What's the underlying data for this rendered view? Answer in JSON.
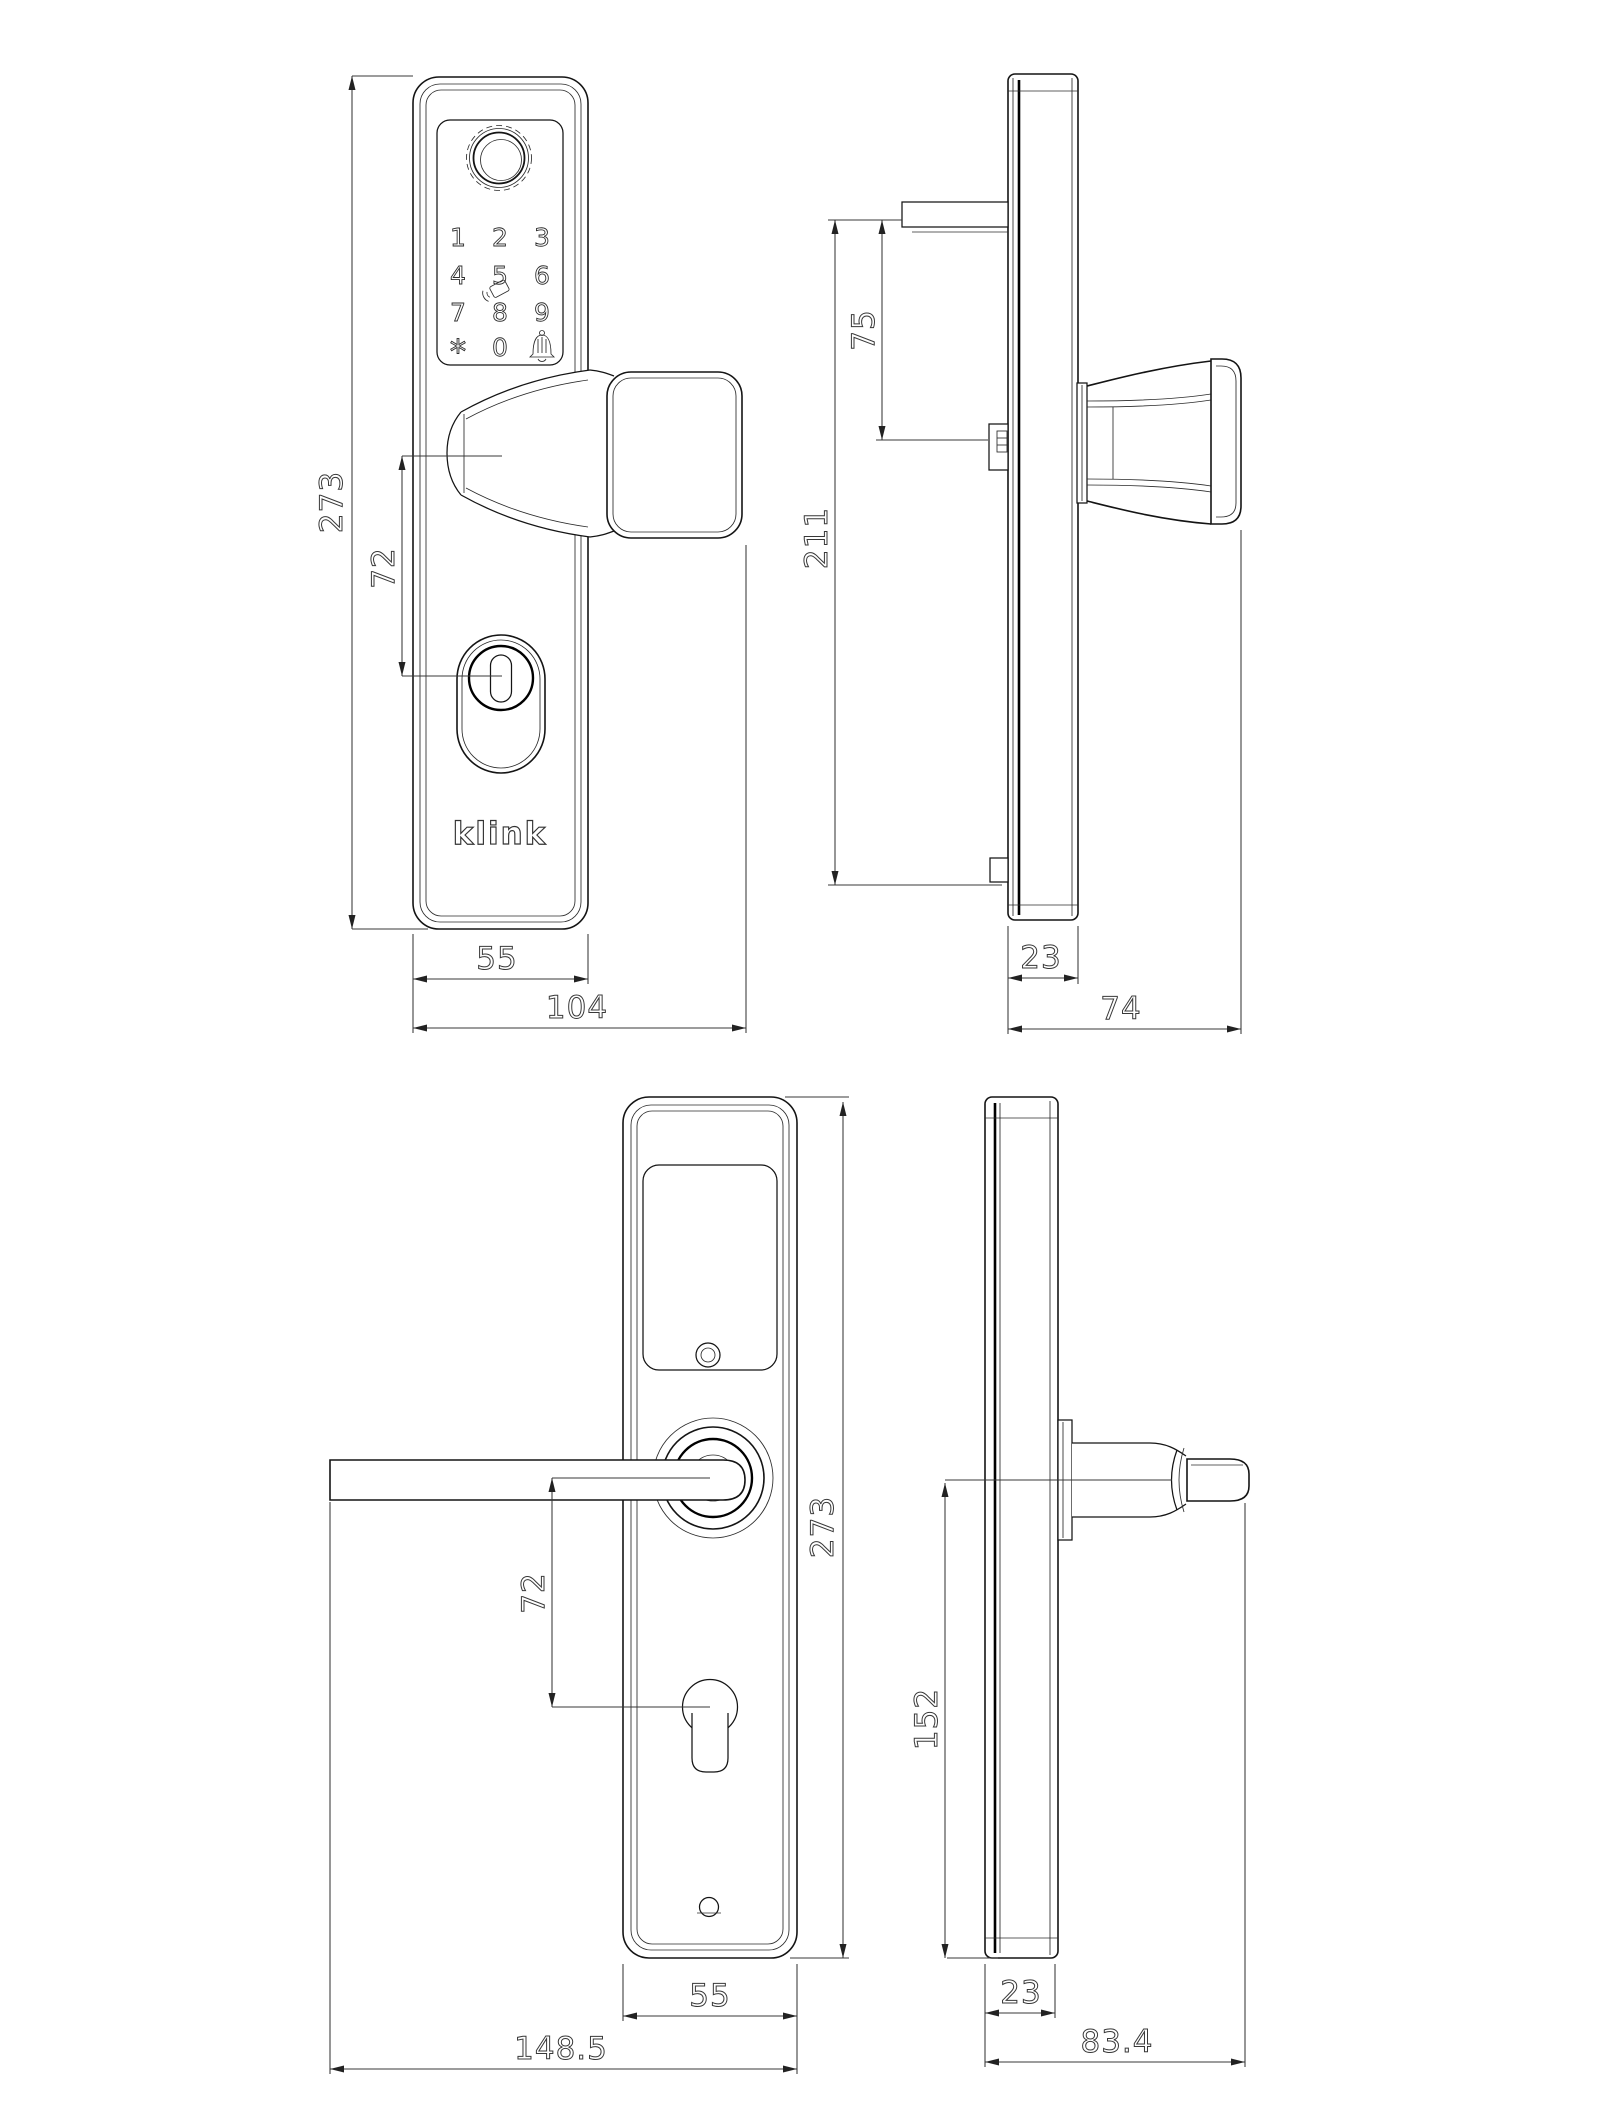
{
  "brand": {
    "logo": "klink"
  },
  "keypad": {
    "keys": [
      "1",
      "2",
      "3",
      "4",
      "5",
      "6",
      "7",
      "8",
      "9",
      "*",
      "0"
    ],
    "icons": [
      "fingerprint-scanner",
      "rfid-card",
      "doorbell"
    ]
  },
  "views": {
    "exterior_front": {
      "dims": {
        "height": "273",
        "handle_to_cylinder": "72",
        "plate_width": "55",
        "overall_width": "104"
      }
    },
    "exterior_side": {
      "dims": {
        "tab_to_spindle": "75",
        "mounting_height": "211",
        "plate_depth": "23",
        "overall_depth": "74"
      }
    },
    "interior_front": {
      "dims": {
        "height": "273",
        "handle_to_cylinder": "72",
        "plate_width": "55",
        "overall_width": "148.5"
      }
    },
    "interior_side": {
      "dims": {
        "handle_center_to_bottom": "152",
        "plate_depth": "23",
        "overall_depth": "83.4"
      }
    }
  }
}
